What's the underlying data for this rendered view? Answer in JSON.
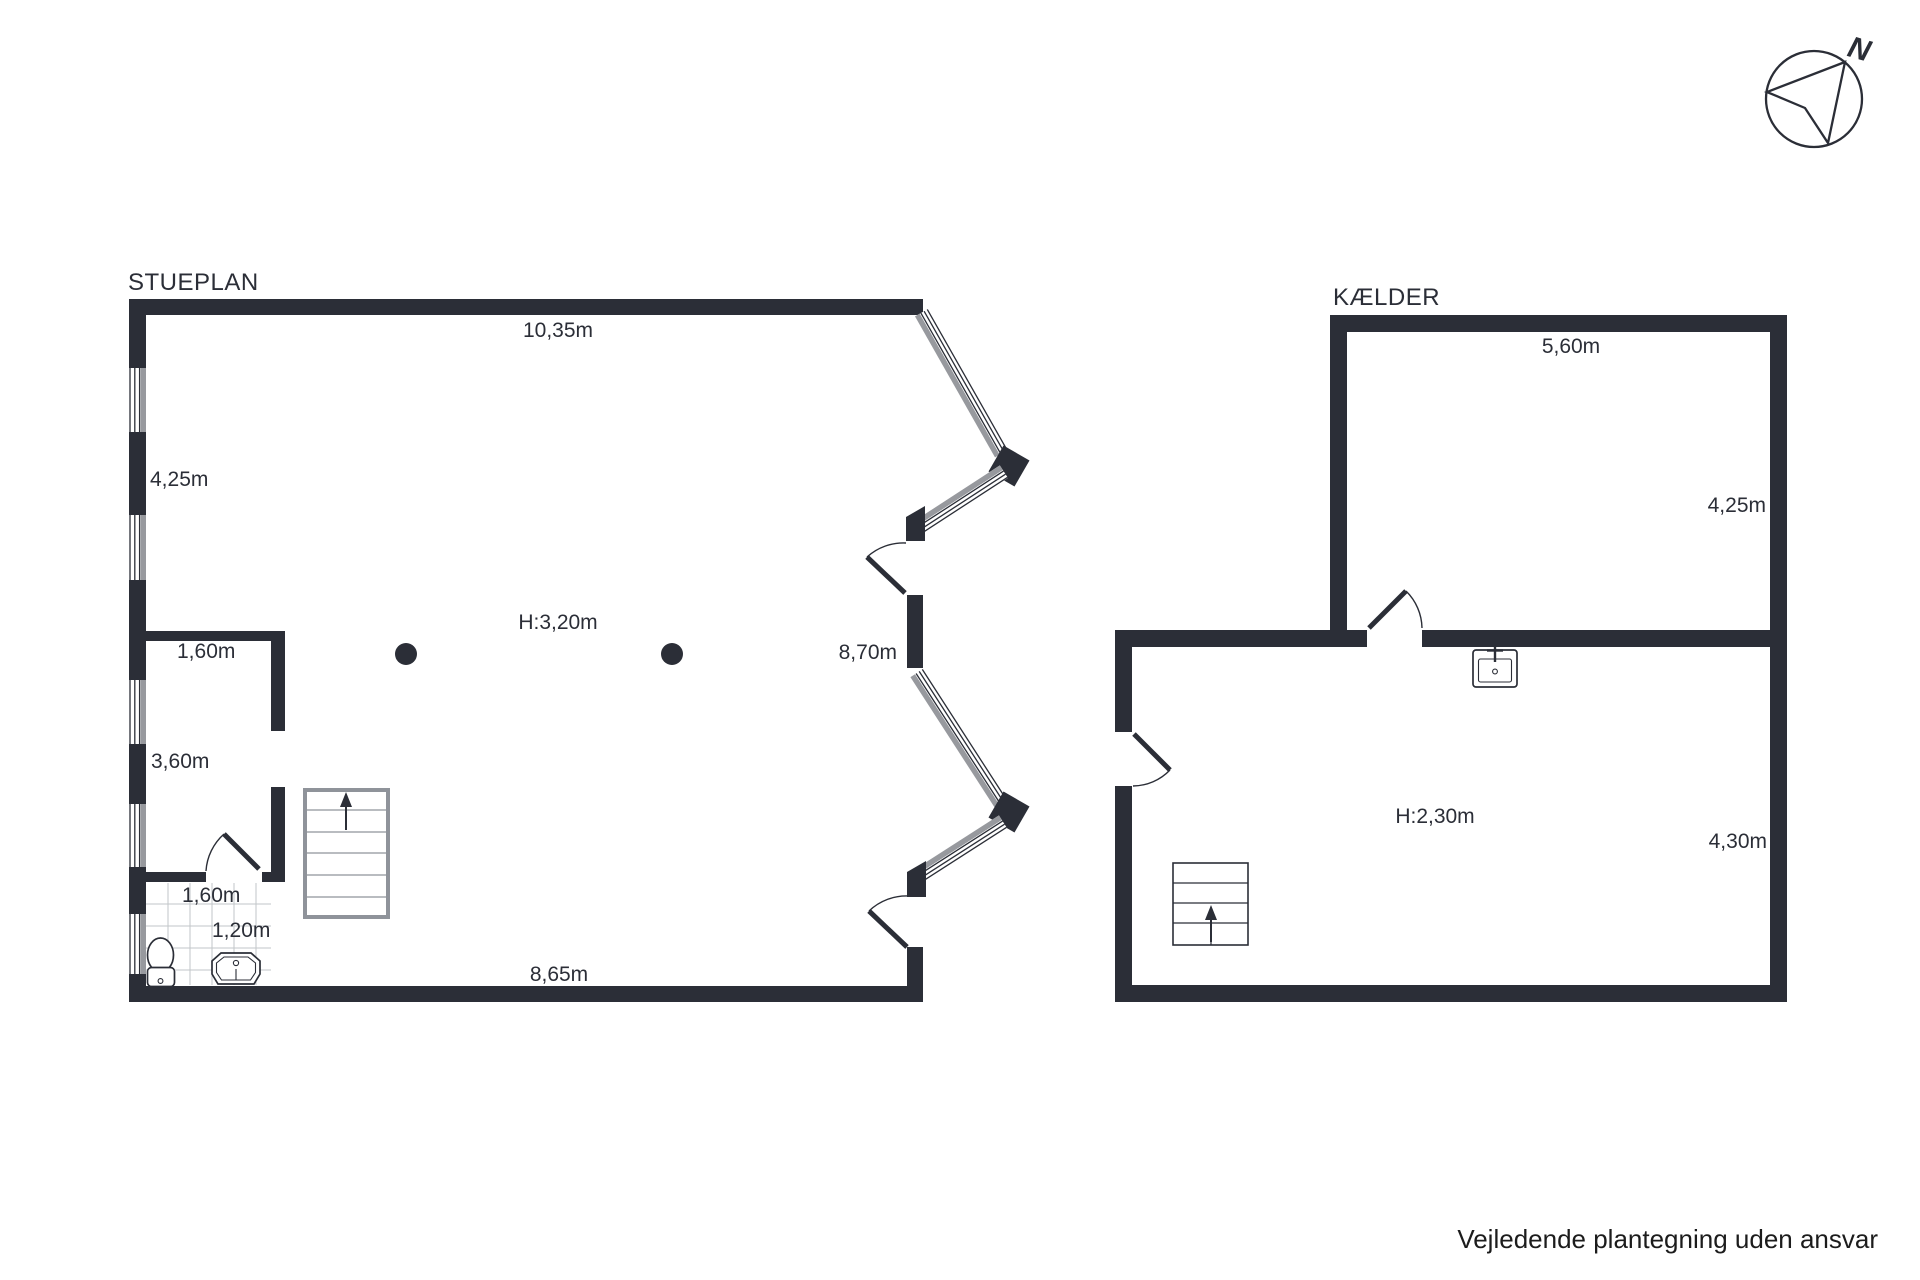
{
  "stueplan": {
    "title": "STUEPLAN",
    "labels": {
      "top_width": "10,35m",
      "left_upper": "4,25m",
      "hall_width": "1,60m",
      "left_lower": "3,60m",
      "bath_width": "1,60m",
      "bath_depth": "1,20m",
      "ceiling_height": "H:3,20m",
      "right_height": "8,70m",
      "bottom_width": "8,65m"
    }
  },
  "kaelder": {
    "title": "KÆLDER",
    "labels": {
      "top_width": "5,60m",
      "right_upper": "4,25m",
      "ceiling_height": "H:2,30m",
      "right_lower": "4,30m"
    }
  },
  "compass": {
    "north_label": "N"
  },
  "footer": {
    "disclaimer": "Vejledende plantegning uden ansvar"
  },
  "colors": {
    "wall": "#2b2e37",
    "window_gray": "#97999e",
    "stair_gray": "#8f939a",
    "background": "#ffffff"
  }
}
